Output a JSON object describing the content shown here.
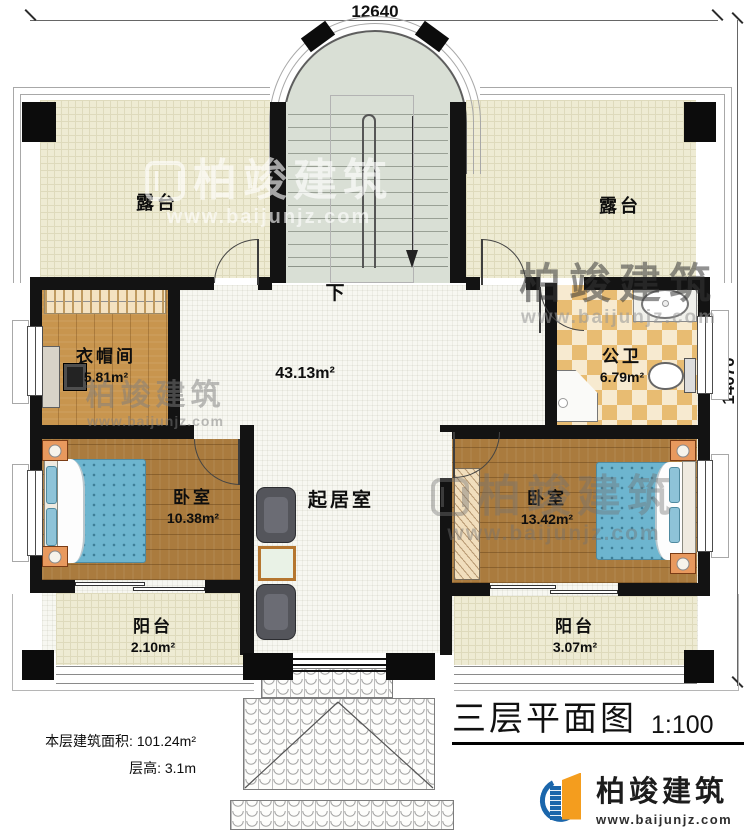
{
  "dims": {
    "width": "12640",
    "height": "14070"
  },
  "stairs": {
    "down_label": "下"
  },
  "rooms": {
    "terrace_left": {
      "name": "露台"
    },
    "terrace_right": {
      "name": "露台"
    },
    "cloakroom": {
      "name": "衣帽间",
      "area": "5.81m²"
    },
    "bathroom": {
      "name": "公卫",
      "area": "6.79m²"
    },
    "living": {
      "name": "起居室",
      "area": "43.13m²"
    },
    "bedroom_left": {
      "name": "卧室",
      "area": "10.38m²"
    },
    "bedroom_right": {
      "name": "卧室",
      "area": "13.42m²"
    },
    "balcony_left": {
      "name": "阳台",
      "area": "2.10m²"
    },
    "balcony_right": {
      "name": "阳台",
      "area": "3.07m²"
    }
  },
  "footer": {
    "area_label": "本层建筑面积:",
    "area_value": "101.24m²",
    "height_label": "层高:",
    "height_value": "3.1m"
  },
  "titleblock": {
    "name": "三层平面图",
    "scale": "1:100"
  },
  "brand": {
    "name": "柏竣建筑",
    "website": "www.baijunjz.com"
  },
  "watermark": {
    "name": "柏竣建筑",
    "website": "www.baijunjz.com"
  },
  "colors": {
    "wall": "#131313",
    "accent_blue": "#1b66ab",
    "accent_orange": "#f49d1e",
    "bed_blue": "#6db5cf",
    "terrace_floor": "#eeebd3",
    "bath_tile": "#e8bc72",
    "wood": "#aa7b3e"
  }
}
